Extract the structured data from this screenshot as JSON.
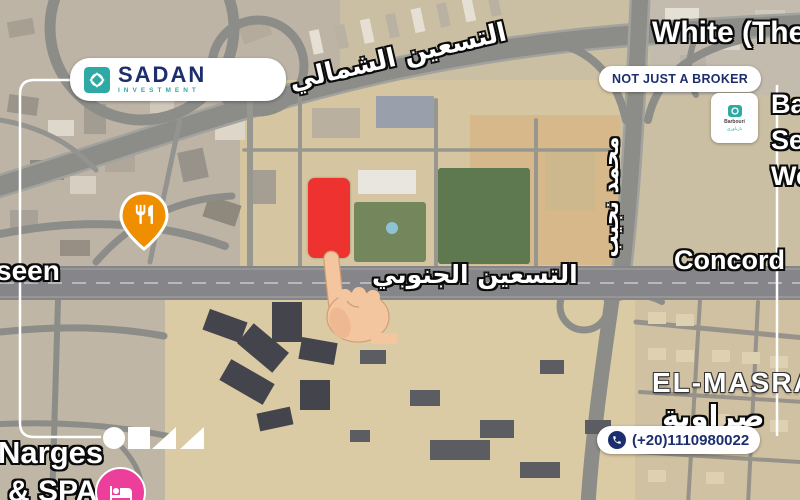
{
  "colors": {
    "plot-red": "#ee3230",
    "brand-navy": "#1c2e6e",
    "brand-teal": "#2fa9a4",
    "pin-orange": "#ef8f00",
    "pin-pink": "#ec3e9b"
  },
  "branding": {
    "logo_title": "SADAN",
    "logo_subtitle": "INVESTMENT",
    "tagline_badge": "NOT JUST A BROKER",
    "phone_number": "(+20)1110980022",
    "partner_name": "Barbouri",
    "partner_name_ar": "بارباوري"
  },
  "map_labels": {
    "street_north_90": "التسعين الشمالي",
    "street_south_90": "التسعين الجنوبي",
    "street_mohamed_naguib": "محمد نجيب",
    "street_left_partial": "seen",
    "district_white": "White (The",
    "district_concord": "Concord",
    "district_elmasra": "EL-MASRA",
    "district_elmasra_arabic": "صراوية",
    "poi_narges": "Narges",
    "poi_spa": "& SPA",
    "edge_right_line1": "Ba",
    "edge_right_line2": "Se",
    "edge_right_line3": "We"
  }
}
